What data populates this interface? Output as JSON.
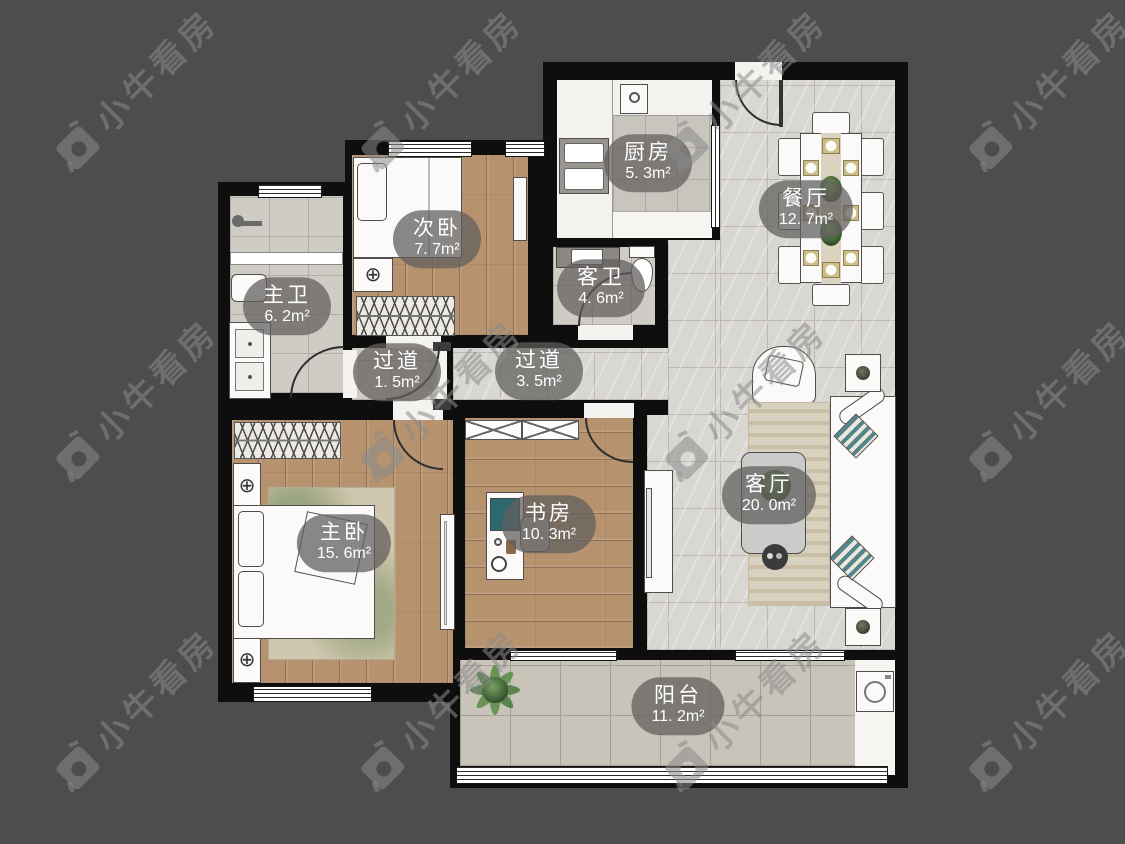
{
  "brand_watermark": {
    "text": "小牛看房"
  },
  "floorplan": {
    "rooms": [
      {
        "key": "kitchen",
        "name": "厨房",
        "area": "5. 3m²"
      },
      {
        "key": "dining-room",
        "name": "餐厅",
        "area": "12. 7m²"
      },
      {
        "key": "second-bedroom",
        "name": "次卧",
        "area": "7. 7m²"
      },
      {
        "key": "master-bathroom",
        "name": "主卫",
        "area": "6. 2m²"
      },
      {
        "key": "guest-bathroom",
        "name": "客卫",
        "area": "4. 6m²"
      },
      {
        "key": "hallway-small",
        "name": "过道",
        "area": "1. 5m²"
      },
      {
        "key": "hallway",
        "name": "过道",
        "area": "3. 5m²"
      },
      {
        "key": "master-bedroom",
        "name": "主卧",
        "area": "15. 6m²"
      },
      {
        "key": "study",
        "name": "书房",
        "area": "10. 3m²"
      },
      {
        "key": "living-room",
        "name": "客厅",
        "area": "20. 0m²"
      },
      {
        "key": "balcony",
        "name": "阳台",
        "area": "11. 2m²"
      }
    ]
  },
  "colors": {
    "background": "#4d4d4d",
    "wall": "#0e0e0e",
    "wood_floor": "#b6926f",
    "tile_floor": "#d9d7d2",
    "label_pill": "rgba(97,95,93,0.74)",
    "label_text": "#ffffff"
  }
}
